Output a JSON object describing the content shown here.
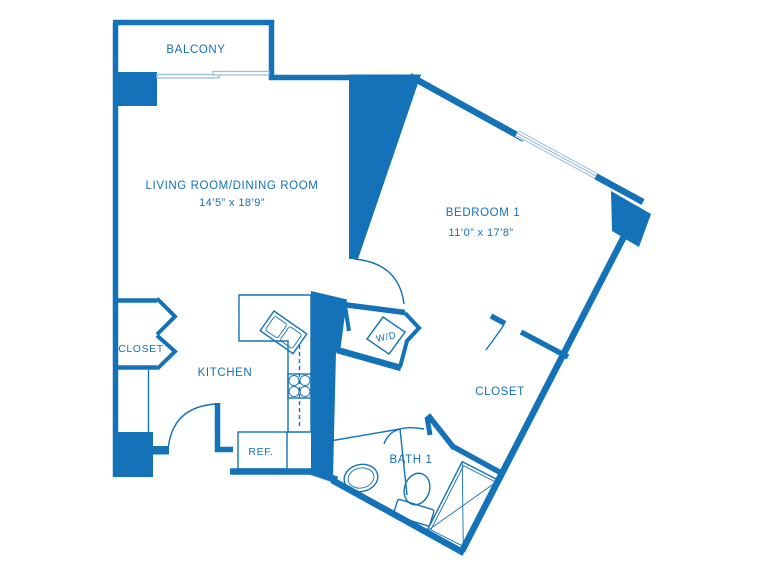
{
  "title": "One-bedroom apartment floor plan",
  "colors": {
    "wall": "#1372b8",
    "light": "#9bbedf"
  },
  "rooms": {
    "balcony": {
      "label": "BALCONY"
    },
    "living": {
      "label": "LIVING ROOM/DINING ROOM",
      "dims": "14’5” x 18’9”"
    },
    "bedroom": {
      "label": "BEDROOM 1",
      "dims": "11’0” x 17’8”"
    },
    "closet_left": {
      "label": "CLOSET"
    },
    "closet_bedroom": {
      "label": "CLOSET"
    },
    "kitchen": {
      "label": "KITCHEN"
    },
    "bath": {
      "label": "BATH 1"
    },
    "laundry": {
      "label": "W/D"
    },
    "fridge": {
      "label": "REF."
    }
  }
}
